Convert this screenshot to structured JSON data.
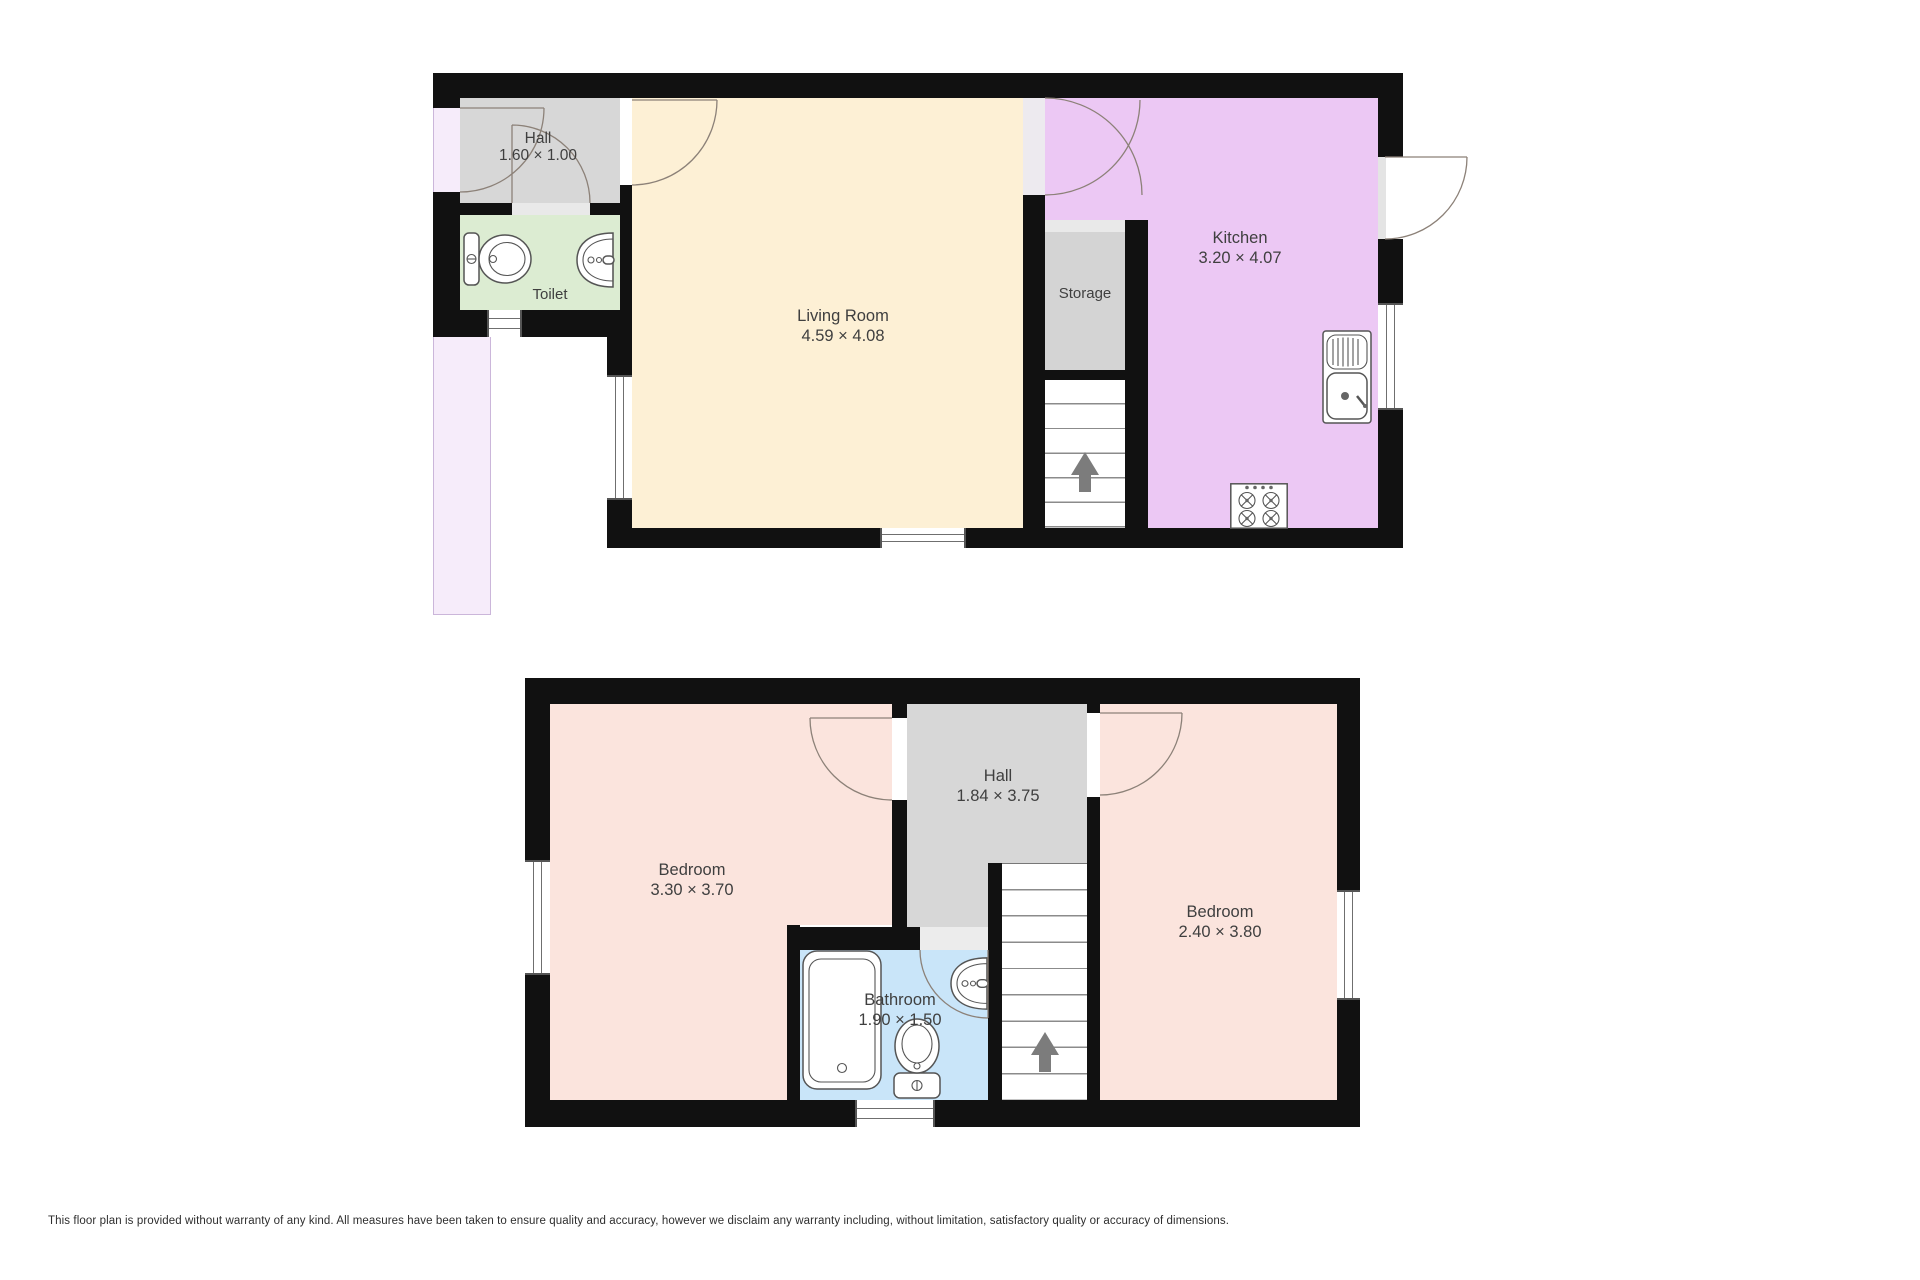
{
  "disclaimer": "This floor plan is provided without warranty of any kind. All measures have been taken to ensure quality and accuracy, however we disclaim any warranty including, without limitation, satisfactory quality or accuracy of dimensions.",
  "ground_floor": {
    "hall": {
      "name": "Hall",
      "dims": "1.60 × 1.00"
    },
    "toilet": {
      "name": "Toilet"
    },
    "living_room": {
      "name": "Living Room",
      "dims": "4.59 × 4.08"
    },
    "storage": {
      "name": "Storage"
    },
    "kitchen": {
      "name": "Kitchen",
      "dims": "3.20 × 4.07"
    }
  },
  "first_floor": {
    "bedroom_left": {
      "name": "Bedroom",
      "dims": "3.30 × 3.70"
    },
    "hall": {
      "name": "Hall",
      "dims": "1.84 × 3.75"
    },
    "bathroom": {
      "name": "Bathroom",
      "dims": "1.90 × 1.50"
    },
    "bedroom_right": {
      "name": "Bedroom",
      "dims": "2.40 × 3.80"
    }
  },
  "colors": {
    "wall": "#111111",
    "living_cream": "#fdf0d5",
    "kitchen_lavender": "#ecc8f4",
    "counter": "#f6ecfa",
    "hall_gray": "#d7d7d7",
    "toilet_green": "#dcecd2",
    "bedroom_pink": "#fbe4dd",
    "bathroom_blue": "#c9e5f9",
    "storage_gray": "#d4d4d4",
    "stairs_arrow": "#7c7c7c",
    "door_arc": "#8c8178",
    "label": "#3f3f3f"
  }
}
